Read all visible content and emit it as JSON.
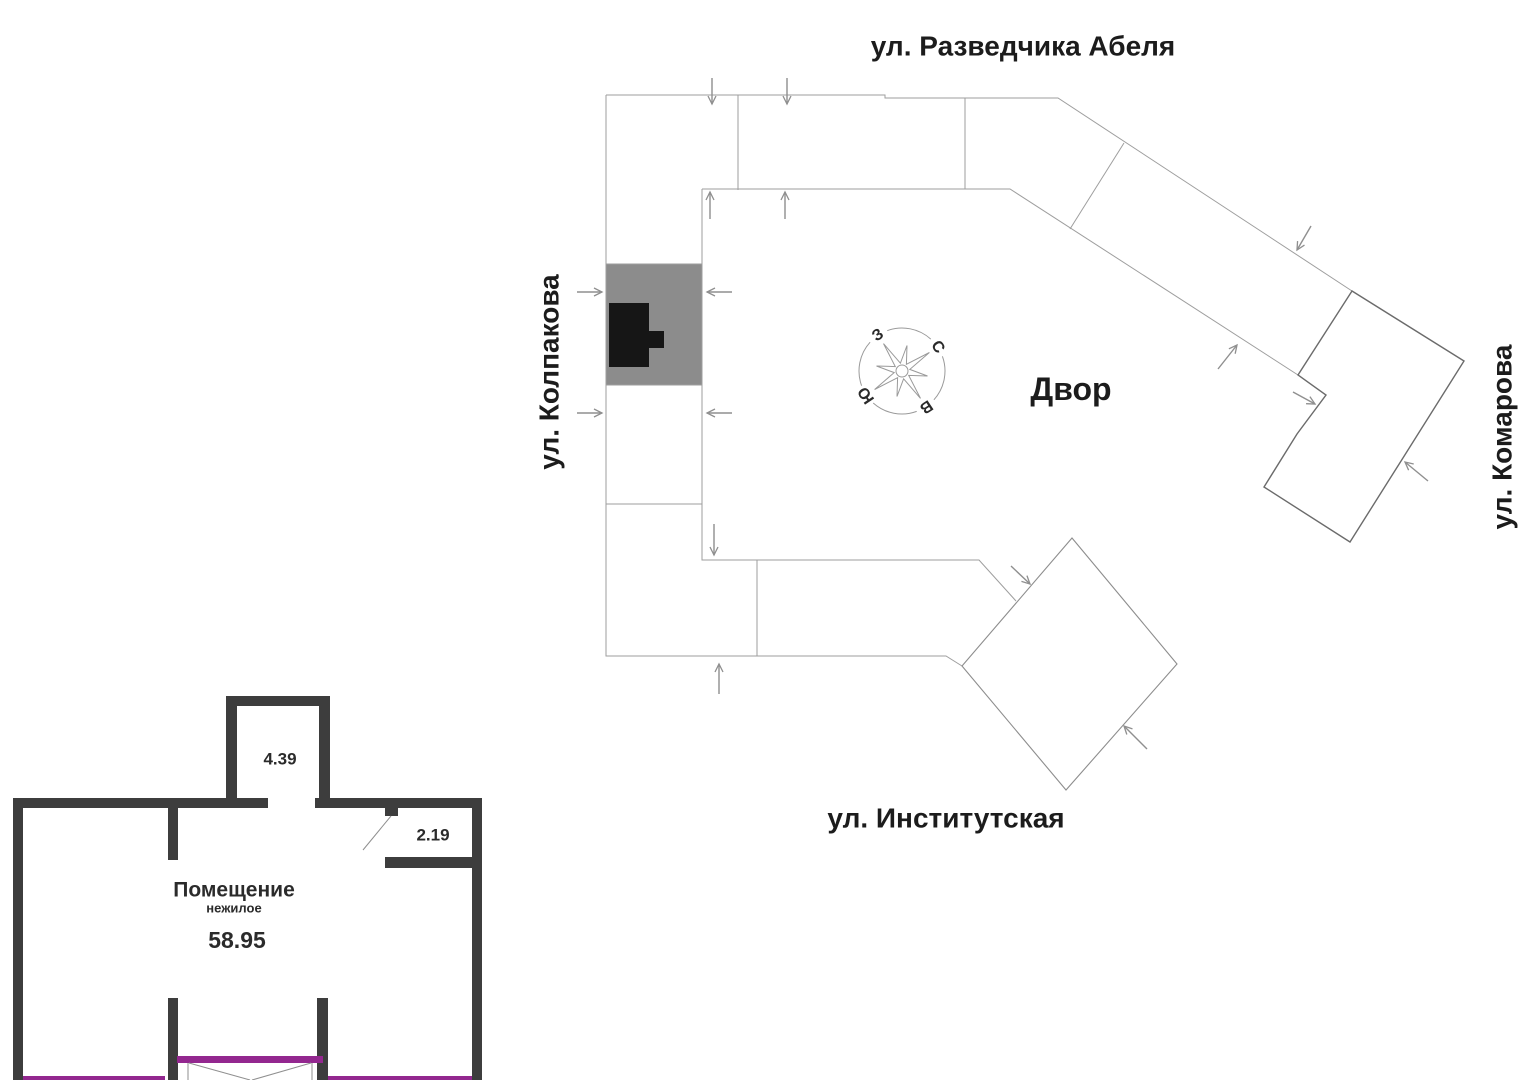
{
  "site_plan": {
    "streets": {
      "top": "ул. Разведчика Абеля",
      "left": "ул. Колпакова",
      "right": "ул. Комарова",
      "bottom": "ул. Институтская"
    },
    "courtyard_label": "Двор",
    "compass": {
      "north": "С",
      "east": "В",
      "south": "Ю",
      "west": "З"
    },
    "icons": {
      "compass": "compass-rose-icon",
      "entrance_arrow": "entrance-arrow-icon"
    },
    "colors": {
      "highlight_block": "#8c8c8c",
      "unit_marker": "#161616"
    }
  },
  "floor_plan": {
    "room": {
      "title": "Помещение",
      "subtitle": "нежилое",
      "area": "58.95"
    },
    "dimensions": {
      "niche_width": "4.39",
      "entry_width": "2.19"
    },
    "colors": {
      "wall": "#3d3d3d",
      "glazing": "#93278f"
    }
  }
}
